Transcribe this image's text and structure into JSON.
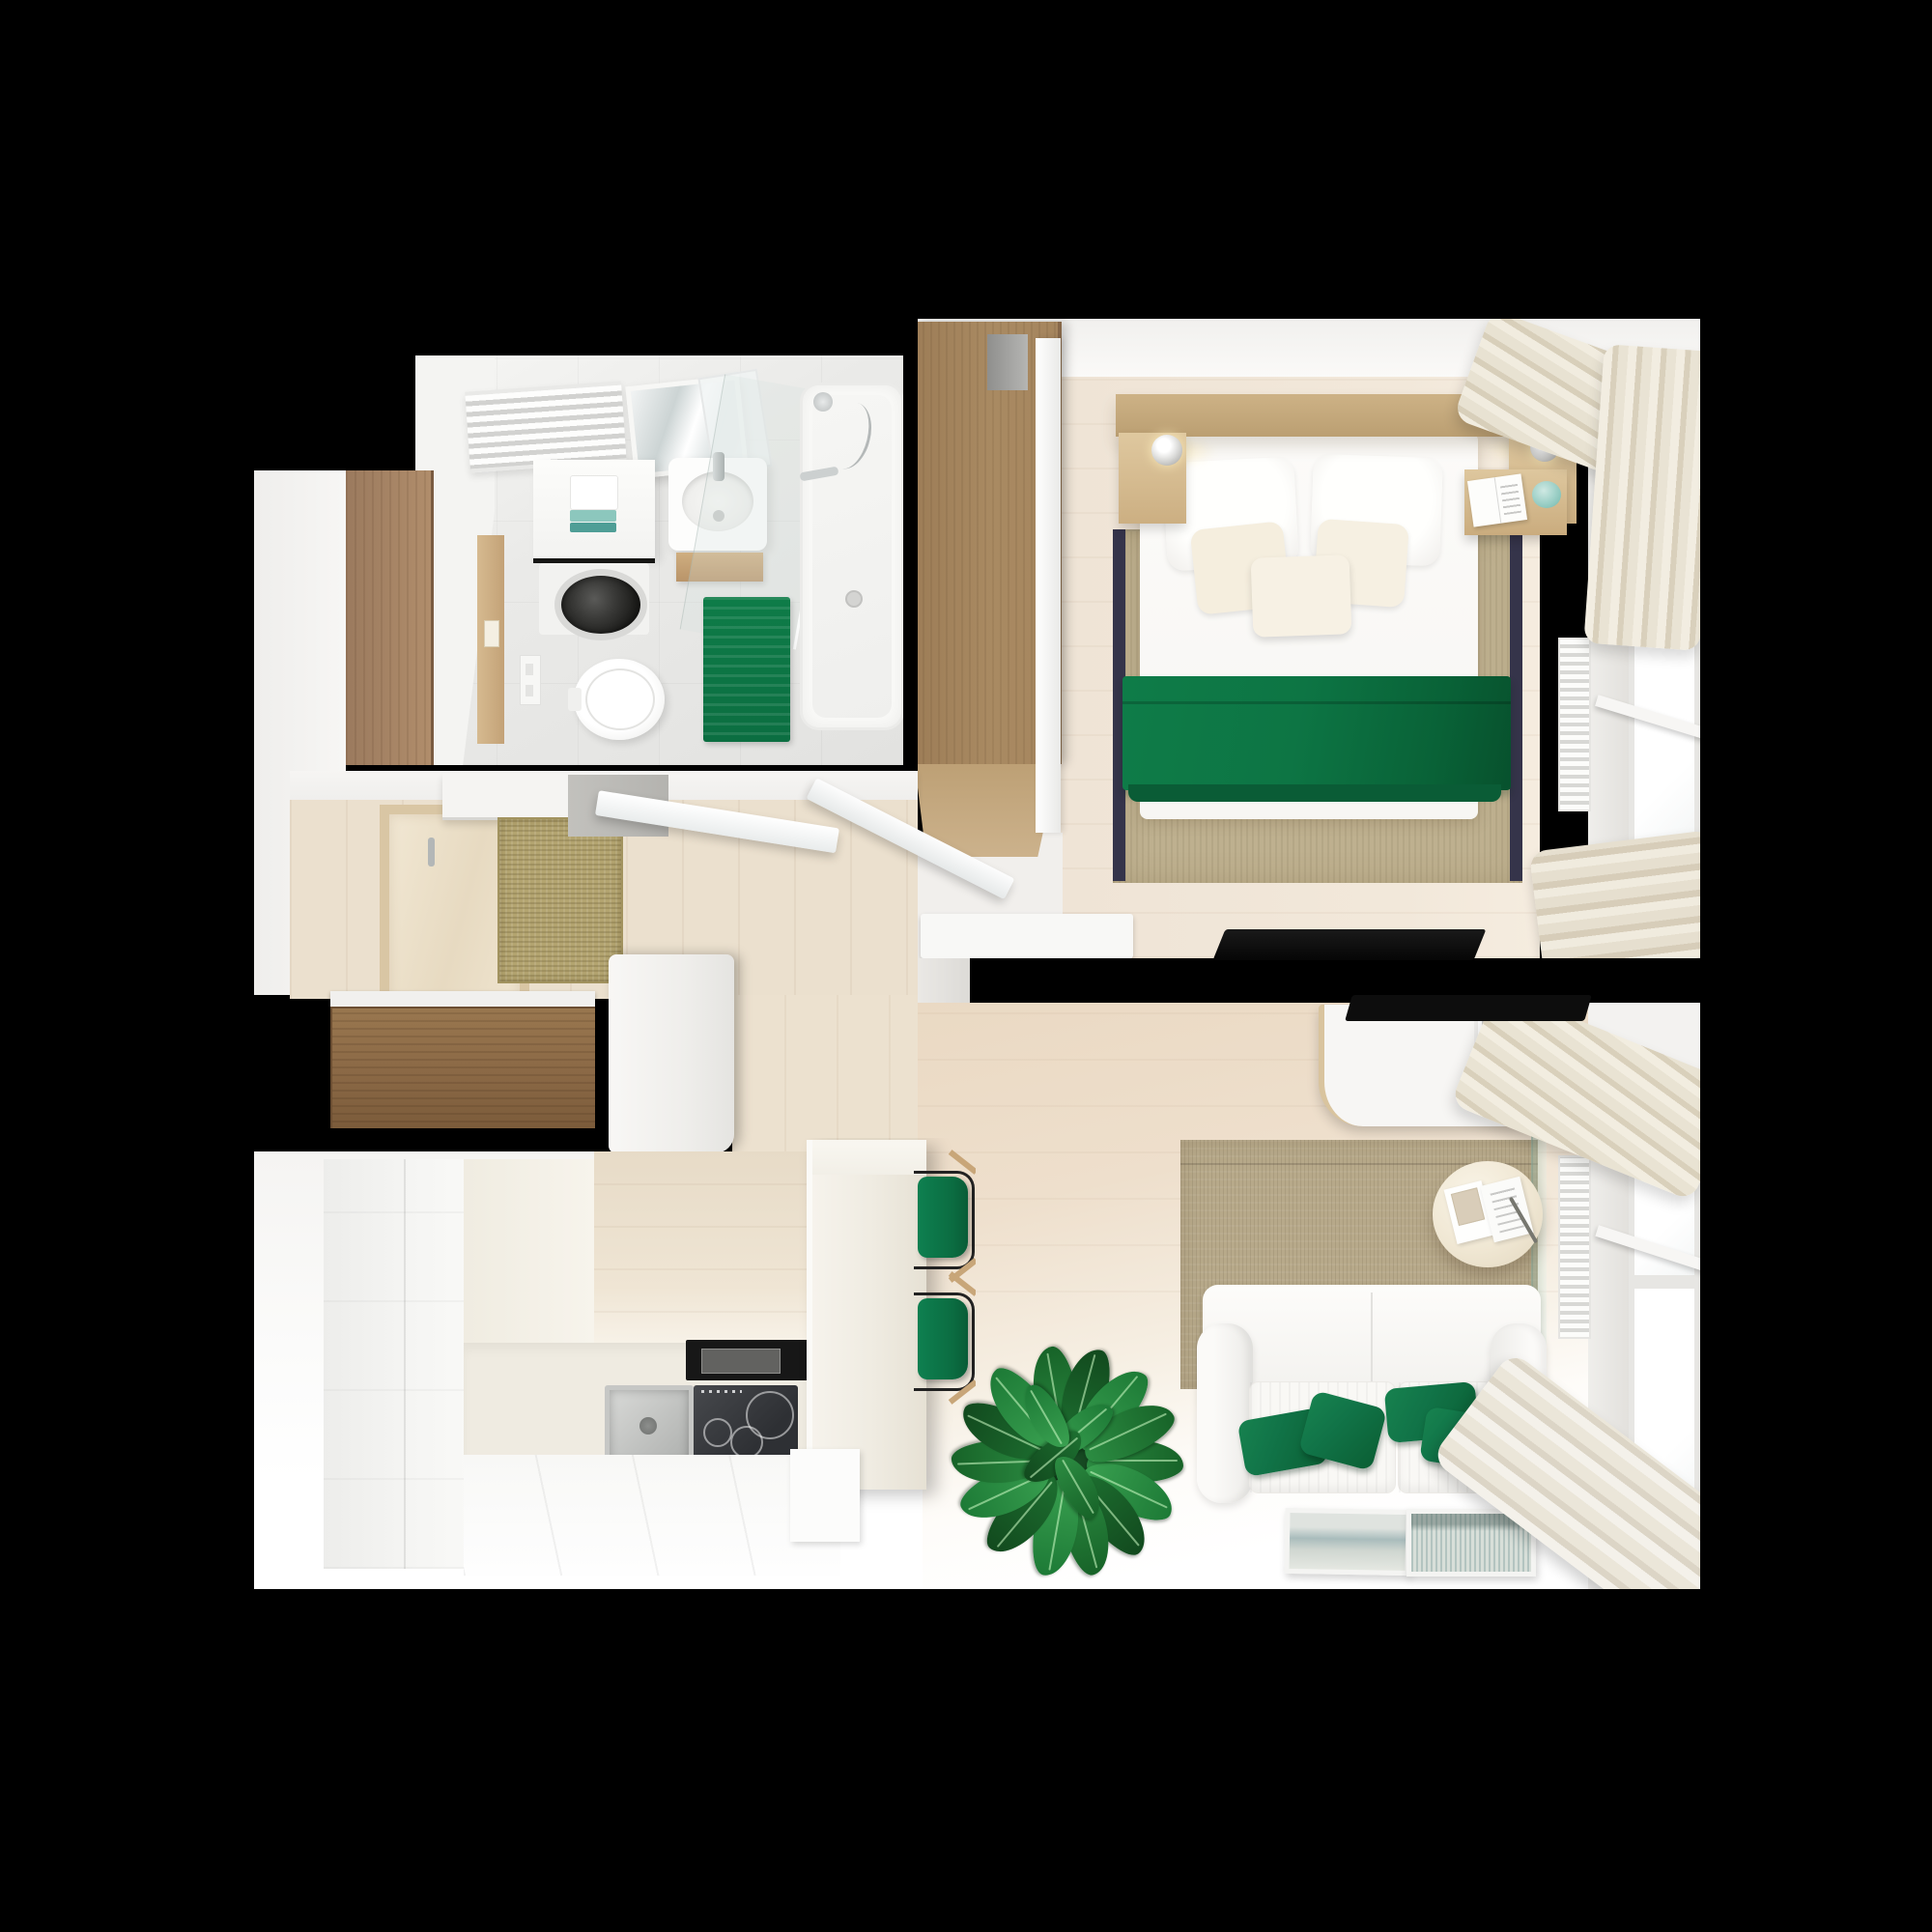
{
  "scene": {
    "title": "Top-down 3D render of a one-bedroom apartment floor plan",
    "type": "floor-plan-render",
    "style": "white and emerald green interior with light oak wood"
  },
  "palette": {
    "background": "#000000",
    "wall-white": "#f3f2f0",
    "floor-wood": "#eee3d4",
    "floor-entry": "#ebe0ce",
    "floor-bath": "#e9e9e7",
    "wood-dark": "#8a6845",
    "wood-mid": "#a98a62",
    "wood-light": "#cdb286",
    "rug-bedroom": "#beb08f",
    "rug-living": "#b7a98a",
    "doormat": "#b3a470",
    "accent-green": "#0e7c48",
    "accent-green-dark": "#0a5c36",
    "green-pillow": "#117448",
    "teal-decor": "#8cc7bd",
    "stone": "#efebe1",
    "curtain": "#e5ddcc",
    "steel": "#aeb0ae",
    "radiator": "#f1f0ee",
    "tv-black": "#0d0d0d",
    "glass": "#ffffff"
  },
  "rooms": [
    {
      "id": "bathroom",
      "label": "Bathroom",
      "furniture": [
        "towel radiator",
        "tilted mirror",
        "laundry counter with teal towels",
        "washing machine",
        "washbasin",
        "wooden shelf",
        "glass shower screen",
        "bathtub with shower set",
        "green bath mat",
        "wall-hung toilet",
        "flush plate",
        "wooden door"
      ]
    },
    {
      "id": "entry-hall",
      "label": "Entry hall",
      "furniture": [
        "wood-framed closet with hook",
        "white shelf",
        "jute doormat",
        "grey landing",
        "open entrance door leaves",
        "dark wood sideboard"
      ]
    },
    {
      "id": "kitchen",
      "label": "Kitchen",
      "furniture": [
        "tall white cabinets",
        "stone countertop",
        "stainless sink",
        "induction hob",
        "black range hood",
        "white cabinet fronts",
        "stone island",
        "green bar stools"
      ]
    },
    {
      "id": "bedroom",
      "label": "Bedroom",
      "furniture": [
        "oak wardrobe",
        "sliding door",
        "double bed",
        "white pillows",
        "emerald green throw",
        "floating headboard with shelves",
        "chrome ball lamps",
        "nightstand with open book and teal knot",
        "bordered sisal rug",
        "white dresser",
        "wall TV",
        "window with radiator",
        "bunched curtains"
      ]
    },
    {
      "id": "living-room",
      "label": "Living room",
      "furniture": [
        "white loveseat sofa",
        "green cushions",
        "sisal rug",
        "round side table with magazine and pen",
        "wall-mounted media cabinet with framed art and teal ball",
        "wall TV",
        "ficus plant",
        "two framed prints on floor",
        "glass divider panel",
        "window with radiator",
        "bunched curtains"
      ]
    }
  ],
  "counts": {
    "sofa_green_cushions": 4,
    "bed_pillows": 5,
    "bar_stools": 2,
    "framed_prints_on_floor": 2,
    "bedside_lamps": 2
  }
}
